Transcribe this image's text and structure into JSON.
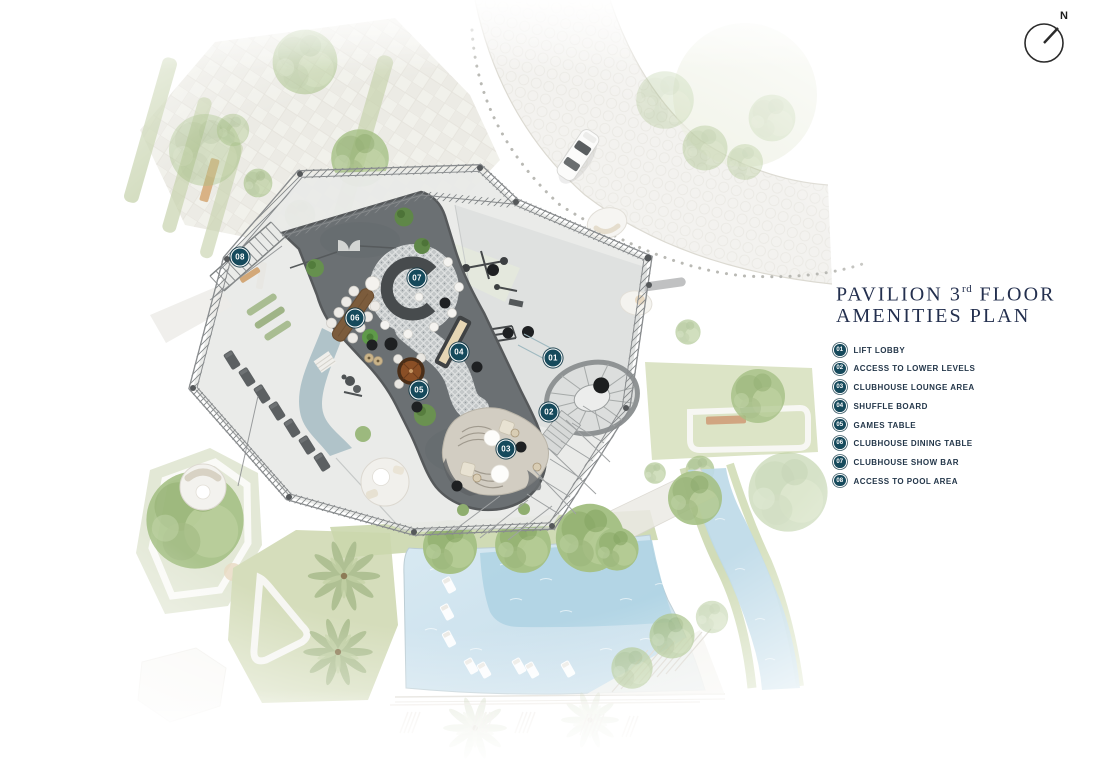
{
  "title": {
    "line1_pre": "PAVILION 3",
    "line1_sup": "rd",
    "line1_post": " FLOOR",
    "line2": "AMENITIES PLAN"
  },
  "compass": {
    "label": "N"
  },
  "legend": {
    "items": [
      {
        "number": "01",
        "label": "LIFT LOBBY"
      },
      {
        "number": "02",
        "label": "ACCESS TO LOWER LEVELS"
      },
      {
        "number": "03",
        "label": "CLUBHOUSE LOUNGE AREA"
      },
      {
        "number": "04",
        "label": "SHUFFLE BOARD"
      },
      {
        "number": "05",
        "label": "GAMES TABLE"
      },
      {
        "number": "06",
        "label": "CLUBHOUSE DINING TABLE"
      },
      {
        "number": "07",
        "label": "CLUBHOUSE SHOW BAR"
      },
      {
        "number": "08",
        "label": "ACCESS TO POOL AREA"
      }
    ]
  },
  "colors": {
    "badge": "#164a5c",
    "title": "#232f4e",
    "legend_text": "#24374a",
    "deck": "#6b7073",
    "deck_edge": "#56595b",
    "show_bar": "#474b4d",
    "mosaic_base": "#c4c8c9",
    "pool": "#cfe2ee",
    "pool_deep": "#aed2e3",
    "lawn": "#cbd7ad",
    "tree": "#a6c186",
    "water_channel": "#aabfc5",
    "truss": "#8a8d8f"
  }
}
